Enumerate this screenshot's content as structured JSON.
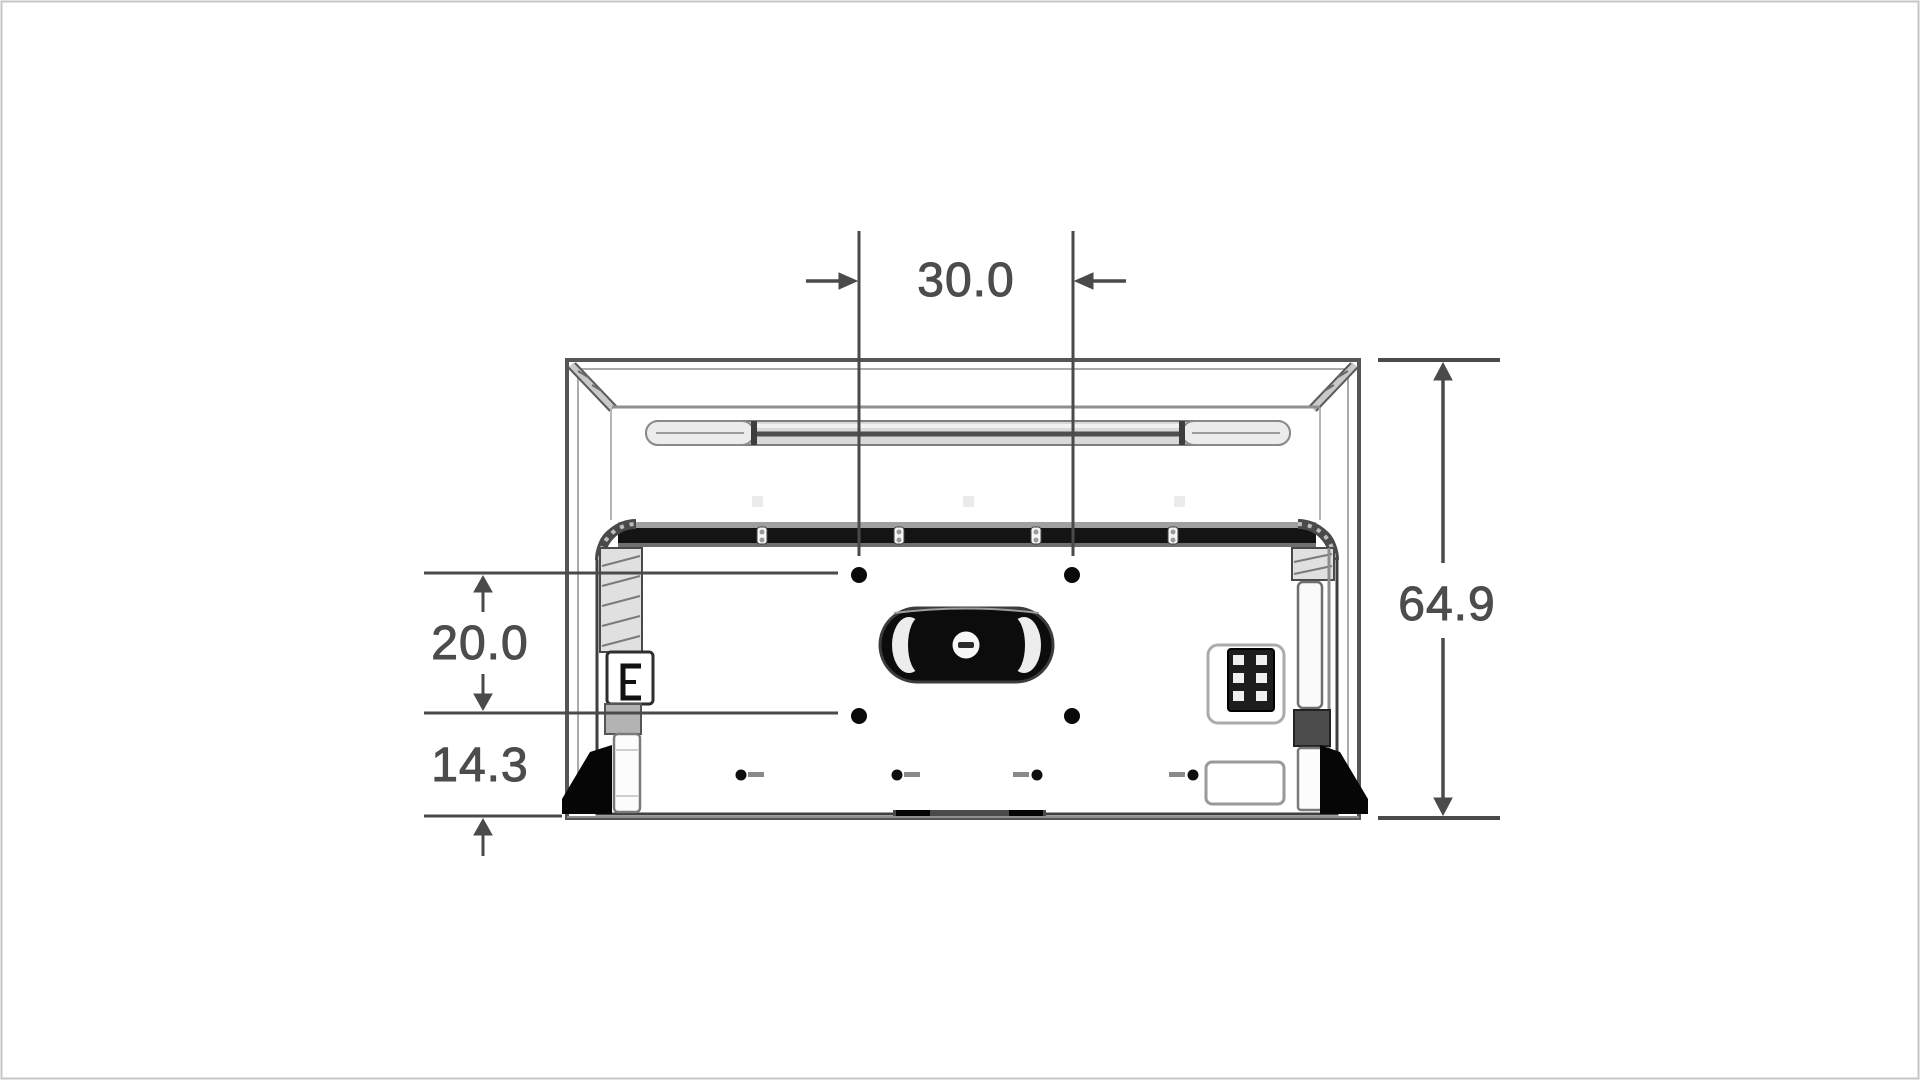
{
  "labels": {
    "mount_width": "30.0",
    "mount_height": "20.0",
    "bottom_offset": "14.3",
    "overall_height": "64.9"
  },
  "colors": {
    "background": "#ffffff",
    "page_border": "#c6c6c6",
    "line": "#4a4a4a",
    "text": "#4d4d4d",
    "dark_fill": "#111111",
    "panel_fill": "#ffffff",
    "light_gray": "#ebebeb"
  }
}
